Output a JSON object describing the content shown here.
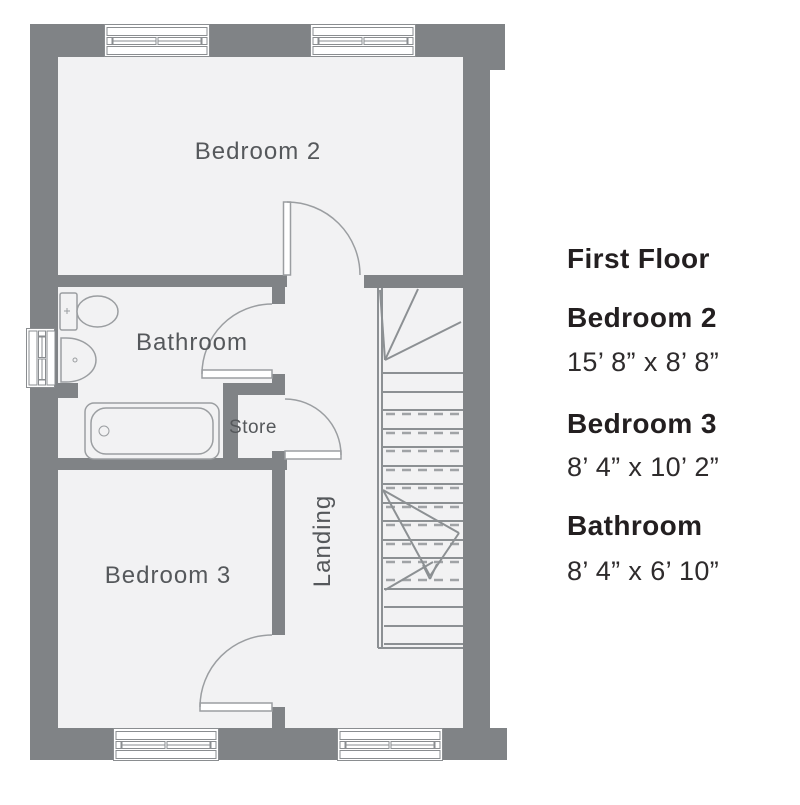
{
  "plan": {
    "room_labels": {
      "bedroom2": "Bedroom 2",
      "bathroom": "Bathroom",
      "store": "Store",
      "bedroom3": "Bedroom 3",
      "landing": "Landing"
    },
    "fixtures": [
      "toilet",
      "basin",
      "bath",
      "staircase"
    ],
    "colors": {
      "wall": "#808386",
      "floor": "#f2f2f3",
      "fixture_line": "#9b9ea1",
      "stair_line": "#8c9093",
      "window_line": "#8a8d90",
      "room_label_text": "#55585b",
      "legend_text": "#231f20",
      "background": "#ffffff"
    }
  },
  "legend": {
    "title": "First Floor",
    "entries": [
      {
        "name": "Bedroom 2",
        "dimensions": "15’ 8” x 8’ 8”"
      },
      {
        "name": "Bedroom 3",
        "dimensions": "8’ 4” x 10’ 2”"
      },
      {
        "name": "Bathroom",
        "dimensions": "8’ 4” x 6’ 10”"
      }
    ]
  }
}
